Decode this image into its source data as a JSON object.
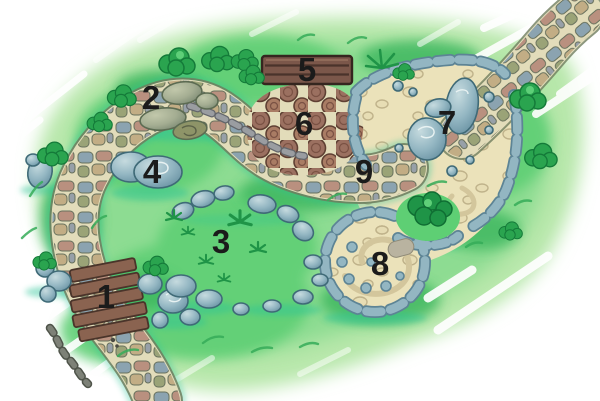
{
  "markers": [
    {
      "label": "1"
    },
    {
      "label": "2"
    },
    {
      "label": "3"
    },
    {
      "label": "4"
    },
    {
      "label": "5"
    },
    {
      "label": "6"
    },
    {
      "label": "7"
    },
    {
      "label": "8"
    },
    {
      "label": "9"
    }
  ],
  "colors": {
    "background": "#ffffff",
    "grass_wash": "#b7e7aa",
    "grass_mid": "#8ddc92",
    "grass_accent": "#5ecf74",
    "grass_stroke": "#35ab58",
    "bush": "#2aa44f",
    "bush_dark": "#1f9447",
    "bush_outline": "#147a39",
    "path_base": "#e2dcba",
    "path_edge": "#6f7d5e",
    "cobble_slate": "#8ba3b0",
    "cobble_rose": "#b9907f",
    "cobble_olive": "#9aa377",
    "cobble_tan": "#c2ad85",
    "sand": "#ebe2ba",
    "sand_pebble": "#bfb28a",
    "sand_swirl": "#d3c69c",
    "stone_blue": "#93b6c2",
    "stone_blue_dark": "#5d8495",
    "boulder_outline": "#3f6a77",
    "log": "#9b7060",
    "log_outline": "#5f4033",
    "wood": "#7b574a",
    "wood_outline": "#35261f",
    "step_wood": "#8a6350",
    "teal_shadow": "#2cc497",
    "marker_text": "#1b1b1b"
  }
}
